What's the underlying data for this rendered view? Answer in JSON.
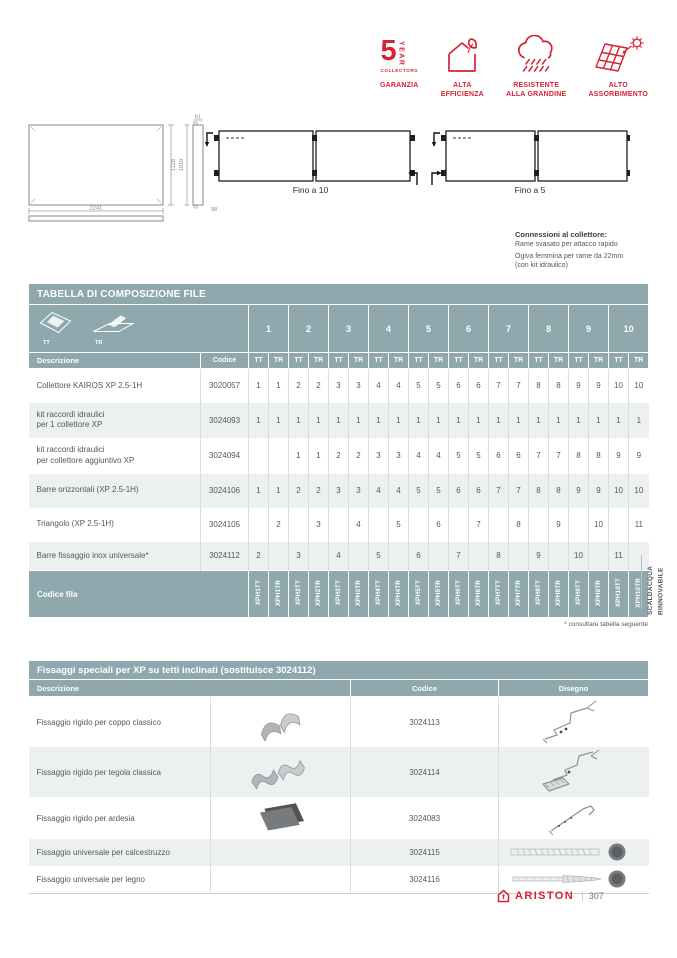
{
  "colors": {
    "teal": "#8ea8ae",
    "row_alt": "#edf0f1",
    "red": "#d62336",
    "text": "#55575a"
  },
  "badges": [
    {
      "name": "warranty-5-year",
      "big": "5",
      "year": "YEAR",
      "collectors": "COLLECTORS",
      "label": "GARANZIA"
    },
    {
      "name": "alta-efficienza",
      "icon": "house-leaf-icon",
      "label": "ALTA\nEFFICIENZA"
    },
    {
      "name": "resistente-grandine",
      "icon": "hail-cloud-icon",
      "label": "RESISTENTE\nALLA GRANDINE"
    },
    {
      "name": "alto-assorbimento",
      "icon": "solar-absorb-icon",
      "label": "ALTO\nASSORBIMENTO"
    }
  ],
  "drawings": {
    "collector_front": {
      "width": "2241",
      "height": "1128",
      "side_top": "61",
      "side_height": "1010",
      "side_depth": "98"
    },
    "row_left": {
      "caption": "Fino a 10"
    },
    "row_right": {
      "caption": "Fino a 5"
    }
  },
  "connections": {
    "title": "Connessioni al collettore:",
    "line1": "Rame svasato per attacco rapido",
    "line2": "Ogiva femmina per rame da 22mm\n(con kit idraulico)"
  },
  "table1": {
    "title": "TABELLA DI COMPOSIZIONE FILE",
    "corner": {
      "tt": "TT",
      "tr": "TR"
    },
    "groups": [
      "1",
      "2",
      "3",
      "4",
      "5",
      "6",
      "7",
      "8",
      "9",
      "10"
    ],
    "sub": {
      "desc": "Descrizione",
      "code": "Codice",
      "tt": "TT",
      "tr": "TR"
    },
    "rows": [
      {
        "desc": "Collettore KAIROS XP 2.5-1H",
        "code": "3020057",
        "values": [
          "1",
          "1",
          "2",
          "2",
          "3",
          "3",
          "4",
          "4",
          "5",
          "5",
          "6",
          "6",
          "7",
          "7",
          "8",
          "8",
          "9",
          "9",
          "10",
          "10"
        ]
      },
      {
        "desc": "kit raccordi idraulici\nper 1 collettore XP",
        "code": "3024093",
        "values": [
          "1",
          "1",
          "1",
          "1",
          "1",
          "1",
          "1",
          "1",
          "1",
          "1",
          "1",
          "1",
          "1",
          "1",
          "1",
          "1",
          "1",
          "1",
          "1",
          "1"
        ]
      },
      {
        "desc": "kit raccordi idraulici\nper collettore aggiuntivo XP",
        "code": "3024094",
        "values": [
          "",
          "",
          "1",
          "1",
          "2",
          "2",
          "3",
          "3",
          "4",
          "4",
          "5",
          "5",
          "6",
          "6",
          "7",
          "7",
          "8",
          "8",
          "9",
          "9"
        ]
      },
      {
        "desc": "Barre orizzontali (XP 2.5-1H)",
        "code": "3024106",
        "values": [
          "1",
          "1",
          "2",
          "2",
          "3",
          "3",
          "4",
          "4",
          "5",
          "5",
          "6",
          "6",
          "7",
          "7",
          "8",
          "8",
          "9",
          "9",
          "10",
          "10"
        ]
      },
      {
        "desc": "Triangolo (XP 2.5-1H)",
        "code": "3024105",
        "values": [
          "",
          "2",
          "",
          "3",
          "",
          "4",
          "",
          "5",
          "",
          "6",
          "",
          "7",
          "",
          "8",
          "",
          "9",
          "",
          "10",
          "",
          "11"
        ]
      },
      {
        "desc": "Barre fissaggio inox universale*",
        "code": "3024112",
        "values": [
          "2",
          "",
          "3",
          "",
          "4",
          "",
          "5",
          "",
          "6",
          "",
          "7",
          "",
          "8",
          "",
          "9",
          "",
          "10",
          "",
          "11",
          ""
        ]
      }
    ],
    "fila": {
      "label": "Codice fila",
      "codes": [
        "XPH1TT",
        "XPH1TR",
        "XPH2TT",
        "XPH2TR",
        "XPH3TT",
        "XPH3TR",
        "XPH4TT",
        "XPH4TR",
        "XPH5TT",
        "XPH5TR",
        "XPH6TT",
        "XPH6TR",
        "XPH7TT",
        "XPH7TR",
        "XPH8TT",
        "XPH8TR",
        "XPH9TT",
        "XPH9TR",
        "XPH10TT",
        "XPH10TR"
      ]
    },
    "footnote": "* consultare tabella seguente"
  },
  "table2": {
    "title": "Fissaggi speciali per XP su tetti inclinati (sostituisce 3024112)",
    "headers": {
      "desc": "Descrizione",
      "code": "Codice",
      "drawing": "Disegno"
    },
    "rows": [
      {
        "desc": "Fissaggio rigido per coppo classico",
        "code": "3024113",
        "photo": "coppo-clamp-photo",
        "drawing": "coppo-bracket-drawing"
      },
      {
        "desc": "Fissaggio rigido per tegola classica",
        "code": "3024114",
        "photo": "tegola-clamp-photo",
        "drawing": "tegola-bracket-drawing"
      },
      {
        "desc": "Fissaggio rigido per ardesia",
        "code": "3024083",
        "photo": "ardesia-plate-photo",
        "drawing": "ardesia-hook-drawing"
      },
      {
        "desc": "Fissaggio universale per calcestruzzo",
        "code": "3024115",
        "photo": "",
        "drawing": "threaded-rod-drawing"
      },
      {
        "desc": "Fissaggio universale per legno",
        "code": "3024116",
        "photo": "",
        "drawing": "wood-screw-drawing"
      }
    ]
  },
  "side_label": "SCALDACQUA\nRINNOVABILE",
  "footer": {
    "brand": "ARISTON",
    "page": "307"
  }
}
